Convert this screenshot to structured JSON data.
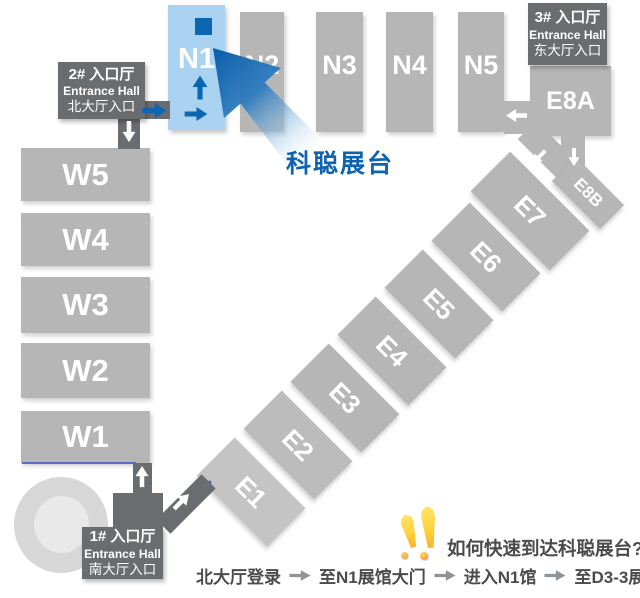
{
  "colors": {
    "hall_gray": "#b6b6b6",
    "hall_gray_light": "#c4c4c4",
    "entrance_box_gray": "#6a6d70",
    "highlight_hall_bg": "#aad3f2",
    "accent_blue": "#0d66b1",
    "booth_text_blue": "#0d63b0",
    "route_text_gray": "#4b4b4b",
    "route_arrow_gray": "#8f9499",
    "attention_yellow": "#ffd23e"
  },
  "halls": {
    "west": [
      {
        "label": "W5"
      },
      {
        "label": "W4"
      },
      {
        "label": "W3"
      },
      {
        "label": "W2"
      },
      {
        "label": "W1"
      }
    ],
    "north_highlight": {
      "label": "N1"
    },
    "north": [
      {
        "label": "N2"
      },
      {
        "label": "N3"
      },
      {
        "label": "N4"
      },
      {
        "label": "N5"
      }
    ],
    "east": [
      {
        "label": "E1"
      },
      {
        "label": "E2"
      },
      {
        "label": "E3"
      },
      {
        "label": "E4"
      },
      {
        "label": "E5"
      },
      {
        "label": "E6"
      },
      {
        "label": "E7"
      }
    ],
    "e8a": {
      "label": "E8A"
    },
    "e8b": {
      "label": "E8B"
    }
  },
  "entrances": {
    "hall2": {
      "line1": "2# 入口厅",
      "line2": "Entrance Hall",
      "line3": "北大厅入口"
    },
    "hall3": {
      "line1": "3# 入口厅",
      "line2": "Entrance Hall",
      "line3": "东大厅入口"
    },
    "hall1": {
      "line1": "1# 入口厅",
      "line2": "Entrance Hall",
      "line3": "南大厅入口"
    }
  },
  "booth": {
    "label": "科聪展台"
  },
  "question": {
    "label": "如何快速到达科聪展台?"
  },
  "route": {
    "steps": [
      "北大厅登录",
      "至N1展馆大门",
      "进入N1馆",
      "至D3-3展台"
    ]
  },
  "icons": {
    "booth_marker": "filled-square",
    "direction_arrow": "solid-arrow",
    "attention": "double-exclamation"
  }
}
